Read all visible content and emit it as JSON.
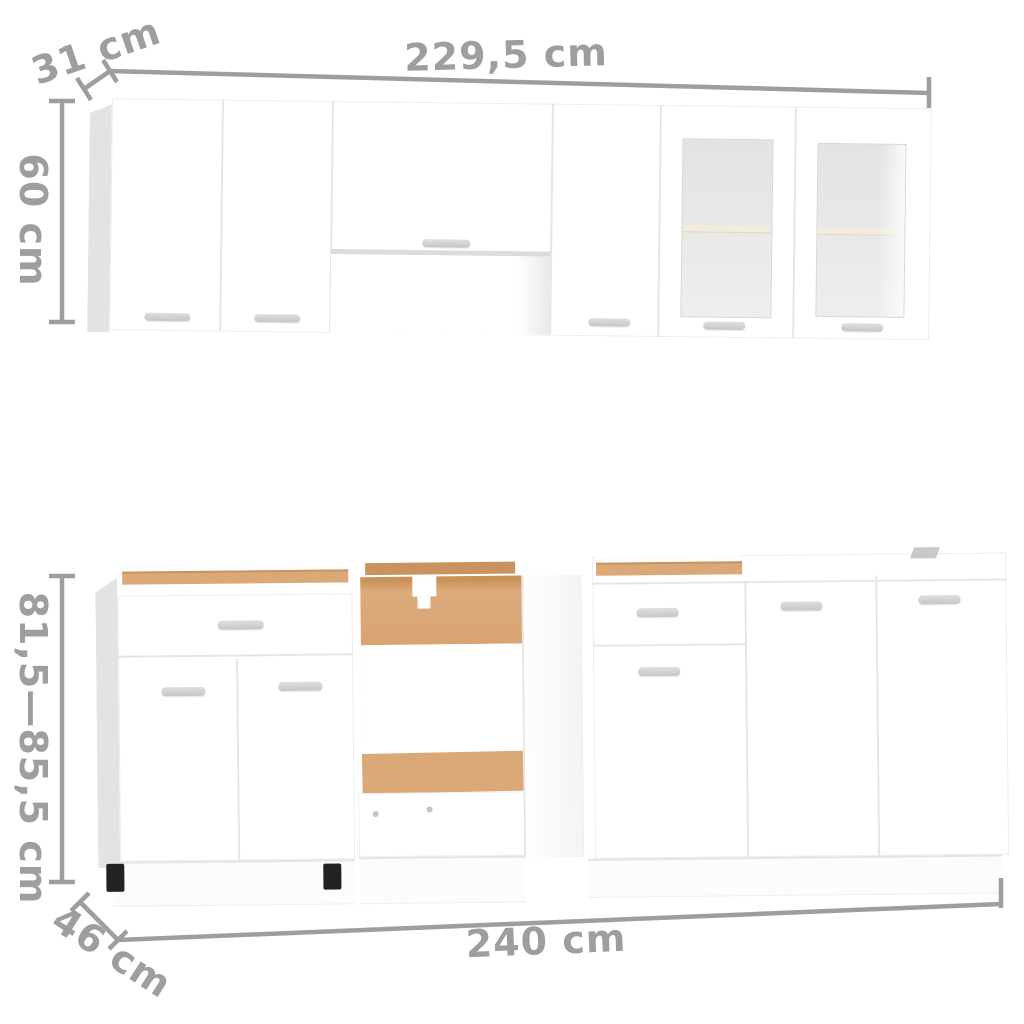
{
  "scene": {
    "description": "White kitchen cabinet furniture set shown front-on with gray dimension annotations",
    "wall_unit": {
      "width_label": "229,5 cm",
      "depth_label": "31 cm",
      "height_label": "60 cm",
      "sections": [
        "door",
        "door",
        "over-hood-cabinet-with-open-recess",
        "door",
        "glass-door",
        "glass-door"
      ]
    },
    "base_unit": {
      "width_label": "240 cm",
      "depth_label": "46 cm",
      "height_label": "81,5—85,5 cm",
      "sections": [
        "drawer-over-two-doors",
        "open-oven-housing",
        "drawer-over-door",
        "door",
        "door"
      ]
    }
  },
  "colors": {
    "background": "#ffffff",
    "annotation": "#9e9e9e",
    "cabinet_white": "#ffffff",
    "seam": "#e6e6e6",
    "side_panel": "#e3e3e3",
    "glass": "#e6e6e6",
    "wood": "#dba878",
    "wood_dark": "#c9935f",
    "handle": "#cfcfcf",
    "foot_black": "#222222"
  }
}
